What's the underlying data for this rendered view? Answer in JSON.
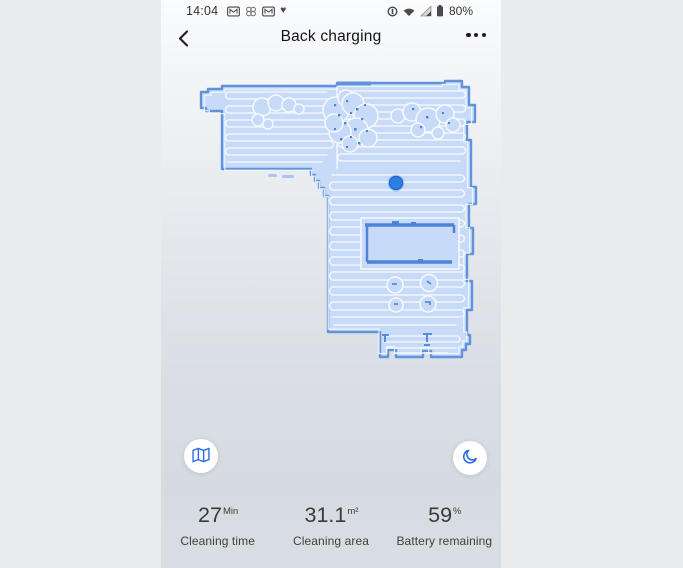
{
  "status_bar": {
    "time": "14:04",
    "battery_percent": "80%",
    "left_icons": [
      "gmail-icon",
      "clover-icon",
      "gmail-icon",
      "heart-icon"
    ],
    "right_icons": [
      "data-saver-icon",
      "wifi-icon",
      "cell-signal-icon",
      "battery-icon"
    ]
  },
  "nav": {
    "title": "Back charging",
    "back_icon": "back-chevron-icon",
    "menu_icon": "more-options-icon"
  },
  "map": {
    "type": "robot-vacuum-cleaning-map",
    "robot_marker": "robot-position-dot",
    "icons": [
      "map-icon",
      "moon-icon"
    ]
  },
  "stats": {
    "items": [
      {
        "value": "27",
        "unit": "Min",
        "label": "Cleaning time"
      },
      {
        "value": "31.1",
        "unit": "m²",
        "label": "Cleaning area"
      },
      {
        "value": "59",
        "unit": "%",
        "label": "Battery remaining"
      }
    ]
  },
  "colors": {
    "page_margin": "#eaebec",
    "map_fill": "#c7daf7",
    "map_border": "#6093dc",
    "path_line": "#f6f9fd",
    "map_detail_dark": "#4d82d6",
    "robot_dot": "#2e7fe2",
    "accent_blue": "#2b6be3"
  }
}
